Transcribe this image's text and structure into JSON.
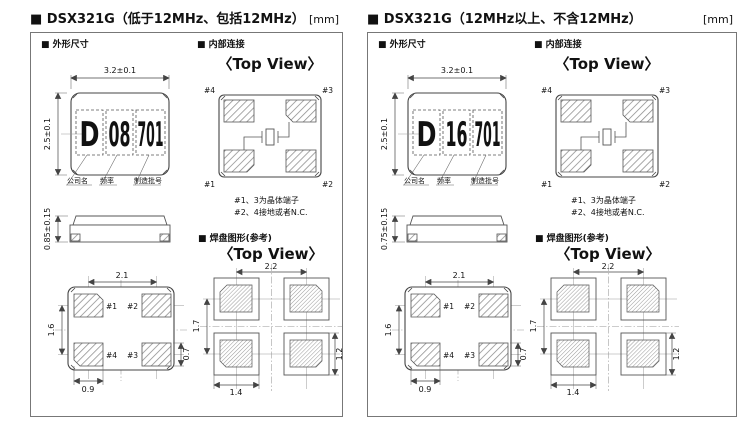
{
  "page": {
    "background": "#ffffff",
    "text_color": "#111111"
  },
  "panels": [
    {
      "id": "low-freq",
      "title": "■ DSX321G（低于12MHz、包括12MHz）",
      "unit": "[mm]",
      "sections": {
        "outline": "■ 外形尺寸",
        "internal": "■ 内部连接",
        "land": "■ 焊盘图形(参考)",
        "top_view": "〈Top View〉"
      },
      "outline": {
        "width_dim": "3.2±0.1",
        "height_dim": "2.5±0.1",
        "thickness_dim": "0.85±0.15",
        "marking": {
          "part1": "D",
          "part2": "08",
          "part3": "701"
        },
        "callouts": {
          "company": "公司名",
          "frequency": "频率",
          "lot": "制造批号"
        }
      },
      "internal": {
        "pins": {
          "p1": "#1",
          "p2": "#2",
          "p3": "#3",
          "p4": "#4"
        },
        "notes": {
          "line1": "#1、3为晶体端子",
          "line2": "#2、4接地或者N.C."
        }
      },
      "bottom": {
        "pitch_x": "2.1",
        "pitch_y": "1.6",
        "pad_w": "0.9",
        "pad_h": "0.7"
      },
      "land": {
        "pitch_x": "2.2",
        "pitch_y": "1.7",
        "pad_w": "1.4",
        "pad_h": "1.2"
      }
    },
    {
      "id": "high-freq",
      "title": "■ DSX321G（12MHz以上、不含12MHz）",
      "unit": "[mm]",
      "sections": {
        "outline": "■ 外形尺寸",
        "internal": "■ 内部连接",
        "land": "■ 焊盘图形(参考)",
        "top_view": "〈Top View〉"
      },
      "outline": {
        "width_dim": "3.2±0.1",
        "height_dim": "2.5±0.1",
        "thickness_dim": "0.75±0.15",
        "marking": {
          "part1": "D",
          "part2": "16",
          "part3": "701"
        },
        "callouts": {
          "company": "公司名",
          "frequency": "频率",
          "lot": "制造批号"
        }
      },
      "internal": {
        "pins": {
          "p1": "#1",
          "p2": "#2",
          "p3": "#3",
          "p4": "#4"
        },
        "notes": {
          "line1": "#1、3为晶体端子",
          "line2": "#2、4接地或者N.C."
        }
      },
      "bottom": {
        "pitch_x": "2.1",
        "pitch_y": "1.6",
        "pad_w": "0.9",
        "pad_h": "0.7"
      },
      "land": {
        "pitch_x": "2.2",
        "pitch_y": "1.7",
        "pad_w": "1.4",
        "pad_h": "1.2"
      }
    }
  ]
}
